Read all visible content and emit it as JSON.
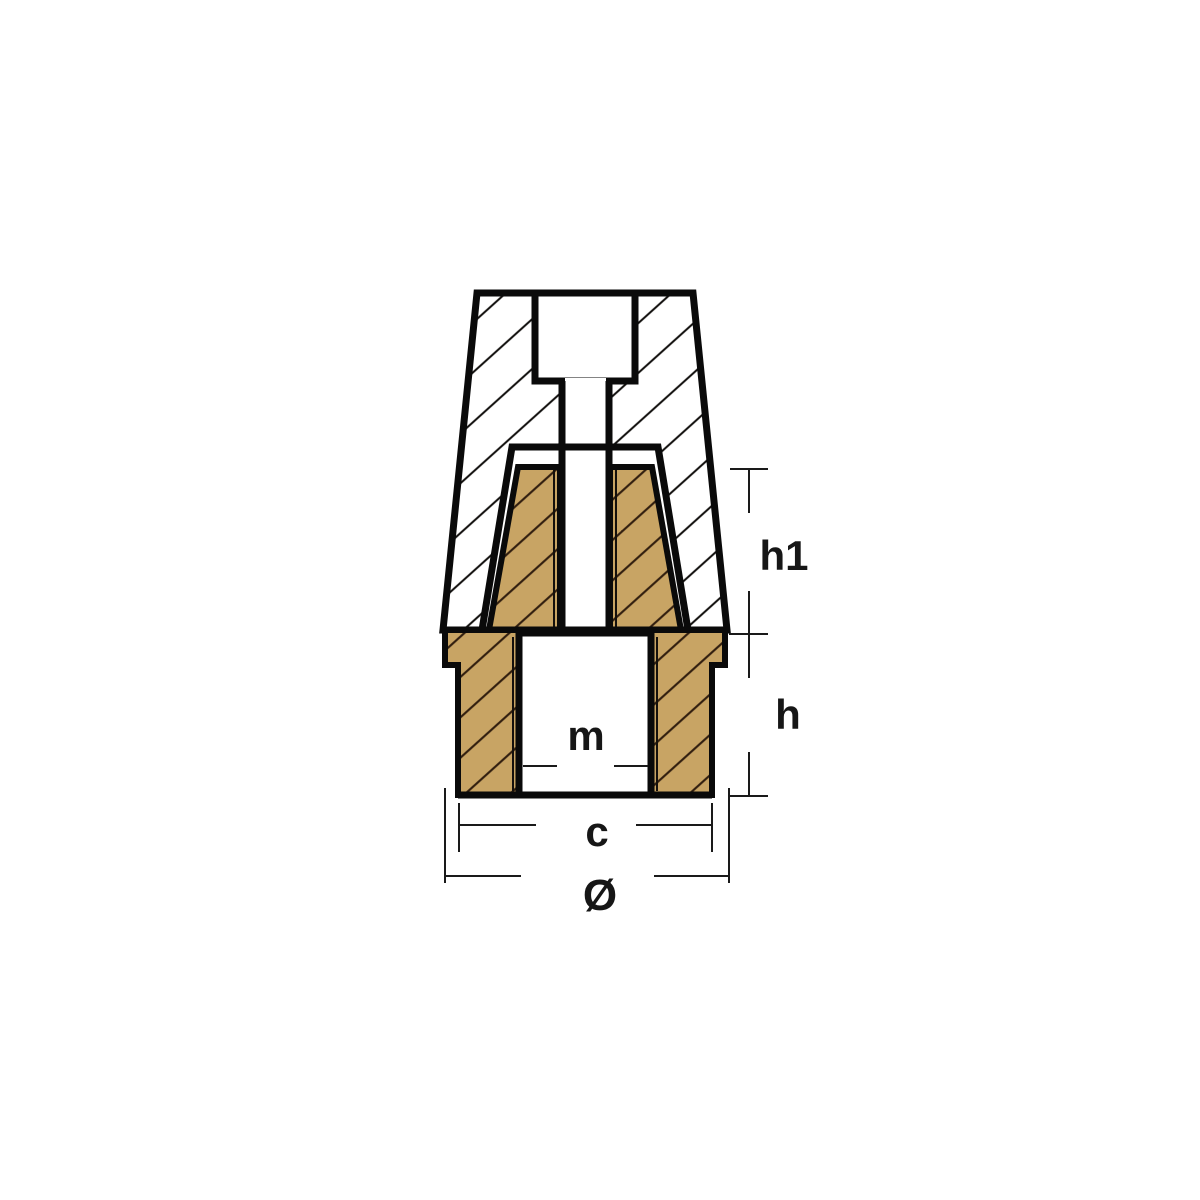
{
  "figure": {
    "kind": "propeller-nut-anode-cross-section",
    "labels": {
      "h1": "h1",
      "h": "h",
      "m": "m",
      "c": "c",
      "diameter": "Ø"
    },
    "colors": {
      "background": "#ffffff",
      "outline": "#0a0a0a",
      "anode_fill": "#ffffff",
      "anode_hatch": "#0e0c0a",
      "insert_fill": "#c8a464",
      "insert_hatch": "#301d0e",
      "dimension_line": "#1a1a1a"
    }
  }
}
